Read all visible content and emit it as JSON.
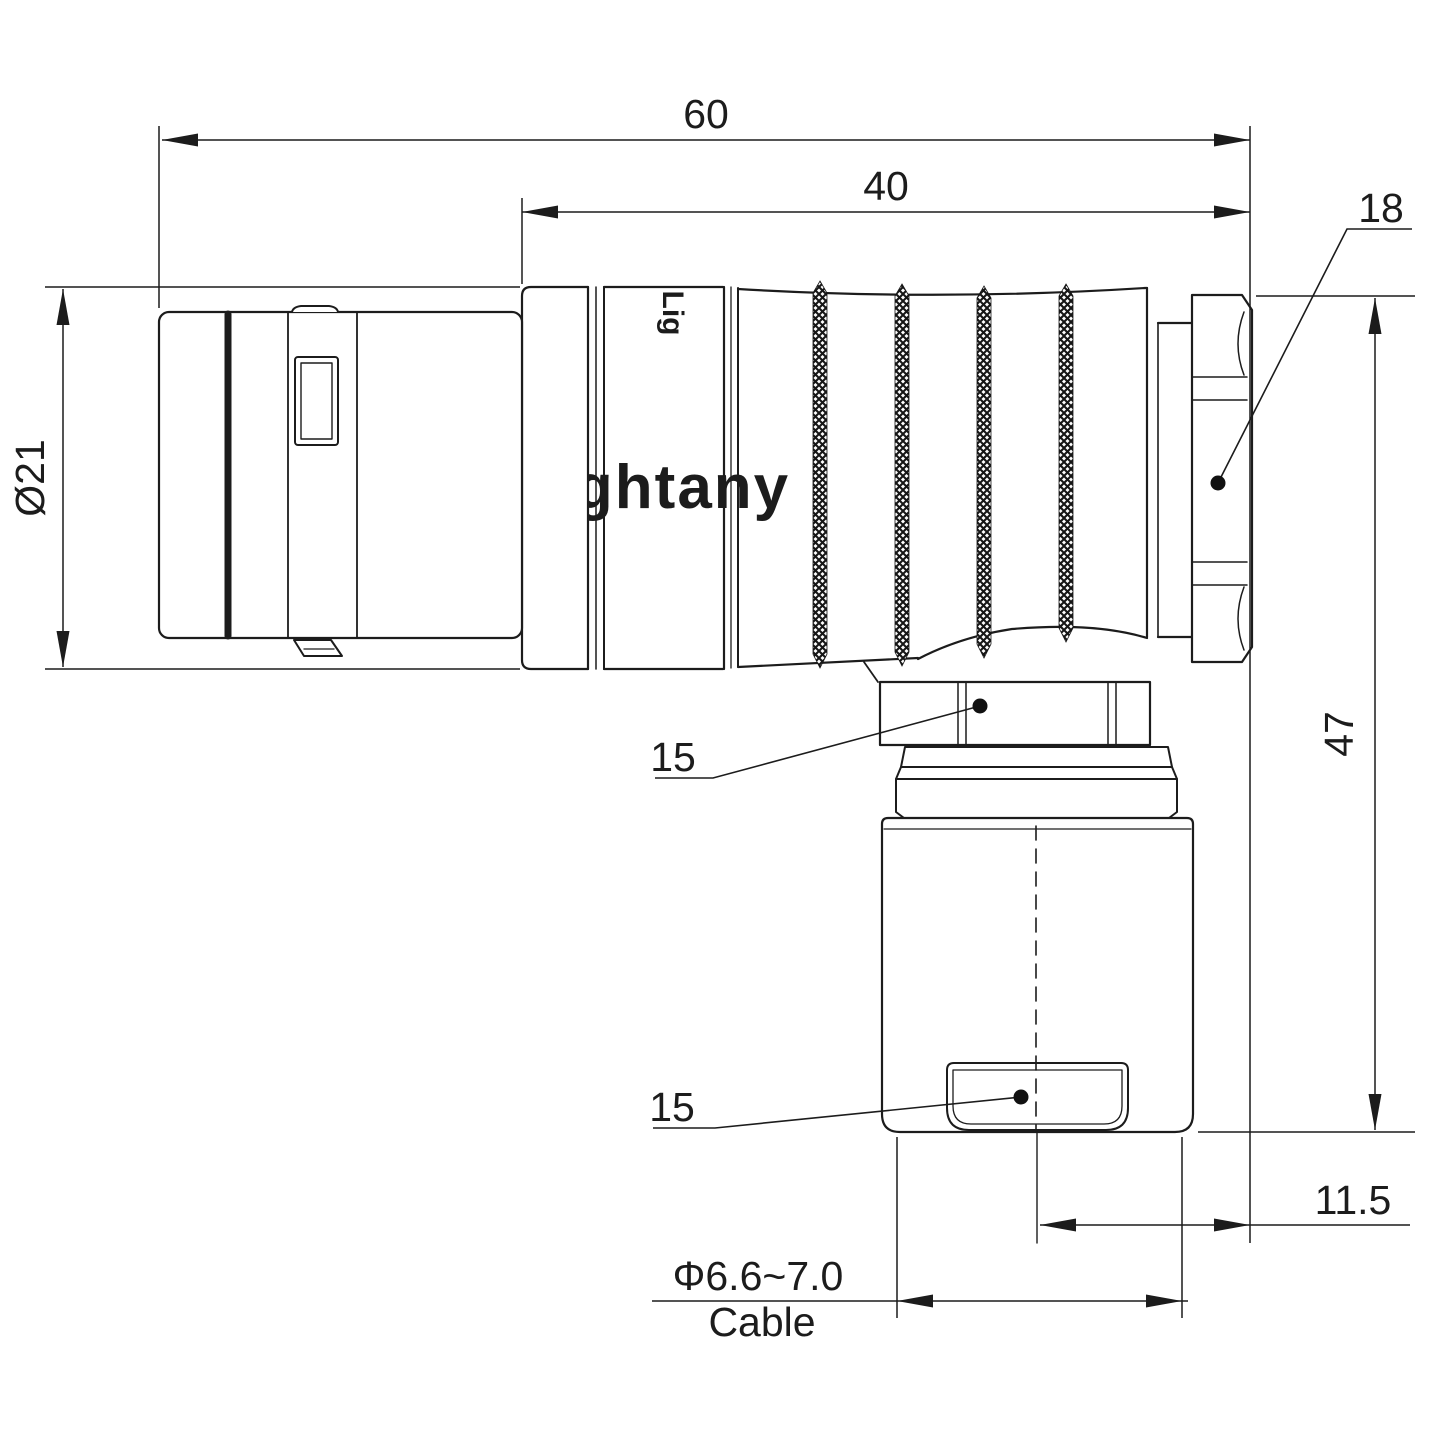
{
  "drawing": {
    "watermark": "Lightany",
    "body_logo": "Lig",
    "colors": {
      "line": "#1c1c1c",
      "watermark_pink": "#f5caca",
      "background": "#ffffff"
    },
    "dimensions": {
      "overall_length": "60",
      "rear_length": "40",
      "coupling_nut_diameter": "18",
      "elbow_nut_width": "15",
      "clamp_nut_width": "15",
      "front_diameter": "Ø21",
      "overall_height": "47",
      "cable_offset": "11.5",
      "cable_diameter_range": "Φ6.6~7.0",
      "cable_label": "Cable"
    }
  }
}
